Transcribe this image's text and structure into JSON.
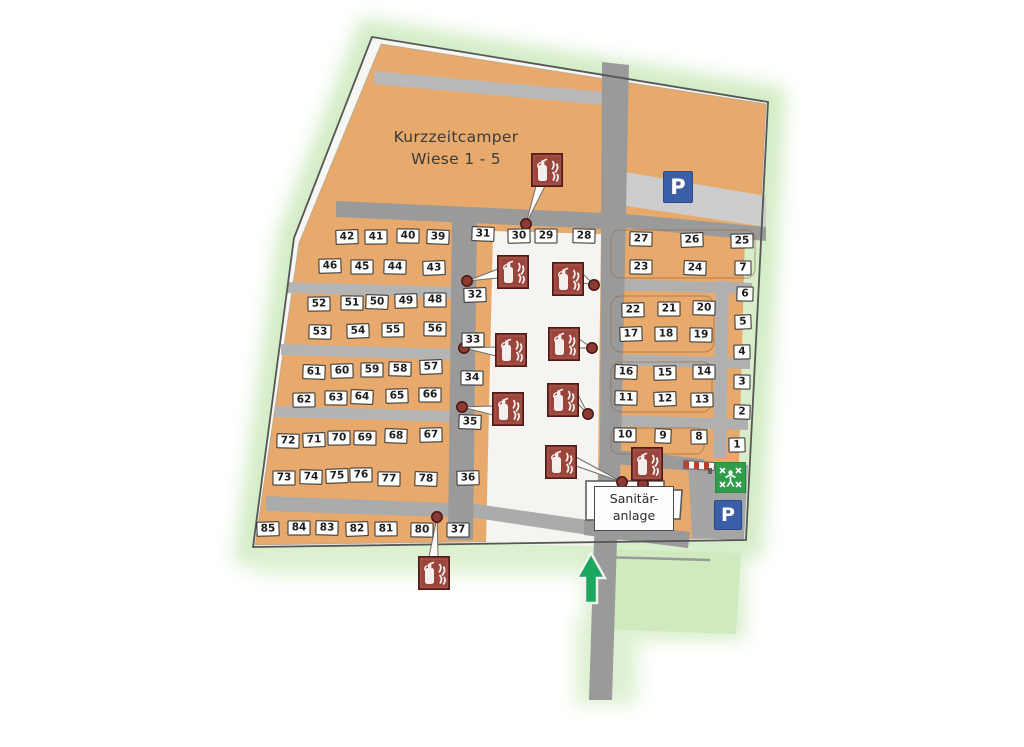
{
  "map": {
    "area_label": {
      "line1": "Kurzzeitcamper",
      "line2": "Wiese 1 - 5"
    },
    "sanitary": {
      "line1": "Sanitär-",
      "line2": "anlage"
    },
    "signs": {
      "parking_top": "P",
      "parking_bottom": "P",
      "playground": "playground-sign",
      "barrier": "boom-barrier",
      "entrance_arrow": "up-arrow"
    },
    "colors": {
      "field_orange": "#e7aa6c",
      "road_gray": "#9a9a9a",
      "extinguisher_red": "#9a443b",
      "parking_blue": "#3b5fa7",
      "playground_green": "#2f9e4b",
      "arrow_green": "#1ba75d",
      "meadow_green": "#cfeabf"
    },
    "pitches": [
      {
        "n": "42",
        "x": 347,
        "y": 237
      },
      {
        "n": "41",
        "x": 376,
        "y": 237
      },
      {
        "n": "40",
        "x": 408,
        "y": 236
      },
      {
        "n": "39",
        "x": 438,
        "y": 237
      },
      {
        "n": "46",
        "x": 330,
        "y": 266
      },
      {
        "n": "45",
        "x": 362,
        "y": 267
      },
      {
        "n": "44",
        "x": 395,
        "y": 267
      },
      {
        "n": "43",
        "x": 434,
        "y": 268
      },
      {
        "n": "52",
        "x": 319,
        "y": 304
      },
      {
        "n": "51",
        "x": 352,
        "y": 303
      },
      {
        "n": "50",
        "x": 377,
        "y": 302
      },
      {
        "n": "49",
        "x": 406,
        "y": 301
      },
      {
        "n": "48",
        "x": 435,
        "y": 300
      },
      {
        "n": "53",
        "x": 320,
        "y": 332
      },
      {
        "n": "54",
        "x": 358,
        "y": 331
      },
      {
        "n": "55",
        "x": 393,
        "y": 330
      },
      {
        "n": "56",
        "x": 435,
        "y": 329
      },
      {
        "n": "61",
        "x": 314,
        "y": 372
      },
      {
        "n": "60",
        "x": 342,
        "y": 371
      },
      {
        "n": "59",
        "x": 372,
        "y": 370
      },
      {
        "n": "58",
        "x": 400,
        "y": 369
      },
      {
        "n": "57",
        "x": 431,
        "y": 367
      },
      {
        "n": "62",
        "x": 304,
        "y": 400
      },
      {
        "n": "63",
        "x": 336,
        "y": 398
      },
      {
        "n": "64",
        "x": 362,
        "y": 397
      },
      {
        "n": "65",
        "x": 397,
        "y": 396
      },
      {
        "n": "66",
        "x": 430,
        "y": 395
      },
      {
        "n": "72",
        "x": 288,
        "y": 441
      },
      {
        "n": "71",
        "x": 314,
        "y": 440
      },
      {
        "n": "70",
        "x": 339,
        "y": 438
      },
      {
        "n": "69",
        "x": 365,
        "y": 438
      },
      {
        "n": "68",
        "x": 396,
        "y": 436
      },
      {
        "n": "67",
        "x": 431,
        "y": 435
      },
      {
        "n": "73",
        "x": 284,
        "y": 478
      },
      {
        "n": "74",
        "x": 311,
        "y": 477
      },
      {
        "n": "75",
        "x": 337,
        "y": 476
      },
      {
        "n": "76",
        "x": 361,
        "y": 475
      },
      {
        "n": "77",
        "x": 389,
        "y": 479
      },
      {
        "n": "78",
        "x": 426,
        "y": 479
      },
      {
        "n": "85",
        "x": 268,
        "y": 529
      },
      {
        "n": "84",
        "x": 299,
        "y": 528
      },
      {
        "n": "83",
        "x": 327,
        "y": 528
      },
      {
        "n": "82",
        "x": 357,
        "y": 529
      },
      {
        "n": "81",
        "x": 386,
        "y": 529
      },
      {
        "n": "80",
        "x": 422,
        "y": 530
      },
      {
        "n": "31",
        "x": 483,
        "y": 234
      },
      {
        "n": "30",
        "x": 519,
        "y": 236
      },
      {
        "n": "29",
        "x": 546,
        "y": 236
      },
      {
        "n": "28",
        "x": 584,
        "y": 236
      },
      {
        "n": "32",
        "x": 475,
        "y": 295
      },
      {
        "n": "33",
        "x": 473,
        "y": 340
      },
      {
        "n": "34",
        "x": 472,
        "y": 378
      },
      {
        "n": "35",
        "x": 470,
        "y": 422
      },
      {
        "n": "36",
        "x": 468,
        "y": 478
      },
      {
        "n": "37",
        "x": 458,
        "y": 530
      },
      {
        "n": "27",
        "x": 641,
        "y": 239
      },
      {
        "n": "26",
        "x": 692,
        "y": 240
      },
      {
        "n": "25",
        "x": 742,
        "y": 241
      },
      {
        "n": "23",
        "x": 641,
        "y": 267
      },
      {
        "n": "24",
        "x": 695,
        "y": 268
      },
      {
        "n": "22",
        "x": 633,
        "y": 310
      },
      {
        "n": "21",
        "x": 669,
        "y": 309
      },
      {
        "n": "20",
        "x": 704,
        "y": 308
      },
      {
        "n": "17",
        "x": 631,
        "y": 334
      },
      {
        "n": "18",
        "x": 666,
        "y": 334
      },
      {
        "n": "19",
        "x": 701,
        "y": 335
      },
      {
        "n": "16",
        "x": 626,
        "y": 372
      },
      {
        "n": "15",
        "x": 665,
        "y": 373
      },
      {
        "n": "14",
        "x": 704,
        "y": 372
      },
      {
        "n": "11",
        "x": 626,
        "y": 398
      },
      {
        "n": "12",
        "x": 665,
        "y": 399
      },
      {
        "n": "13",
        "x": 702,
        "y": 400
      },
      {
        "n": "10",
        "x": 625,
        "y": 435
      },
      {
        "n": "9",
        "x": 663,
        "y": 436
      },
      {
        "n": "8",
        "x": 699,
        "y": 437
      },
      {
        "n": "7",
        "x": 743,
        "y": 268
      },
      {
        "n": "6",
        "x": 745,
        "y": 294
      },
      {
        "n": "5",
        "x": 743,
        "y": 322
      },
      {
        "n": "4",
        "x": 742,
        "y": 352
      },
      {
        "n": "3",
        "x": 742,
        "y": 382
      },
      {
        "n": "2",
        "x": 742,
        "y": 412
      },
      {
        "n": "1",
        "x": 737,
        "y": 445
      }
    ],
    "extinguishers": [
      {
        "x": 531,
        "y": 153,
        "dot": [
          526,
          224
        ],
        "side": "bottom"
      },
      {
        "x": 497,
        "y": 255,
        "dot": [
          467,
          281
        ],
        "side": "left"
      },
      {
        "x": 552,
        "y": 262,
        "dot": [
          594,
          285
        ],
        "side": "right"
      },
      {
        "x": 495,
        "y": 333,
        "dot": [
          464,
          348
        ],
        "side": "left"
      },
      {
        "x": 548,
        "y": 327,
        "dot": [
          592,
          348
        ],
        "side": "right"
      },
      {
        "x": 492,
        "y": 392,
        "dot": [
          462,
          407
        ],
        "side": "left"
      },
      {
        "x": 547,
        "y": 383,
        "dot": [
          588,
          414
        ],
        "side": "right"
      },
      {
        "x": 545,
        "y": 445,
        "dot": [
          622,
          482
        ],
        "side": "right"
      },
      {
        "x": 631,
        "y": 447,
        "dot": [
          643,
          484
        ],
        "side": "bottom"
      },
      {
        "x": 418,
        "y": 556,
        "dot": [
          437,
          517
        ],
        "side": "top"
      }
    ]
  }
}
